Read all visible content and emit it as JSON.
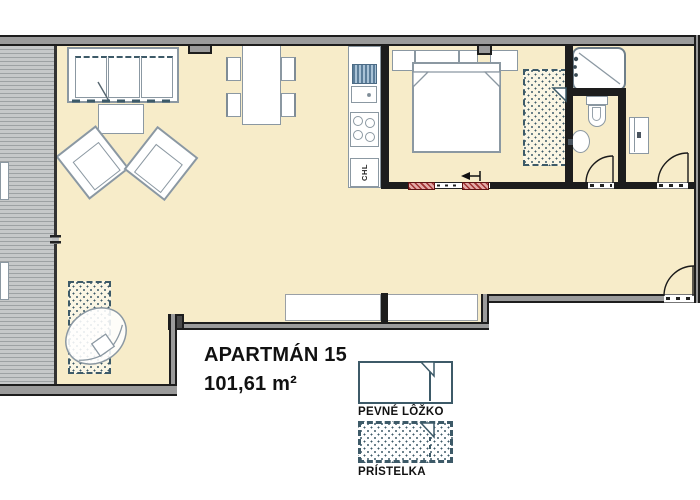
{
  "plan": {
    "title": "APARTMÁN 15",
    "area": "101,61 m²"
  },
  "kitchen": {
    "fridge_label": "CHL"
  },
  "legend": {
    "fixed_bed": {
      "label": "PEVNÉ LÔŽKO"
    },
    "extra_bed": {
      "label": "PRÍSTELKA"
    }
  },
  "colors": {
    "floor": "#f7ecc9",
    "terrace": "#bcbec0",
    "terrace_line": "#9da1a3",
    "wall_dark": "#1d1d1d",
    "wall_fill": "#9b9b9b",
    "outline": "#8b98a2",
    "accent": "#3d5a68",
    "door_red": "#a03030",
    "door_red_light": "#e2a9a7",
    "text": "#111111"
  }
}
